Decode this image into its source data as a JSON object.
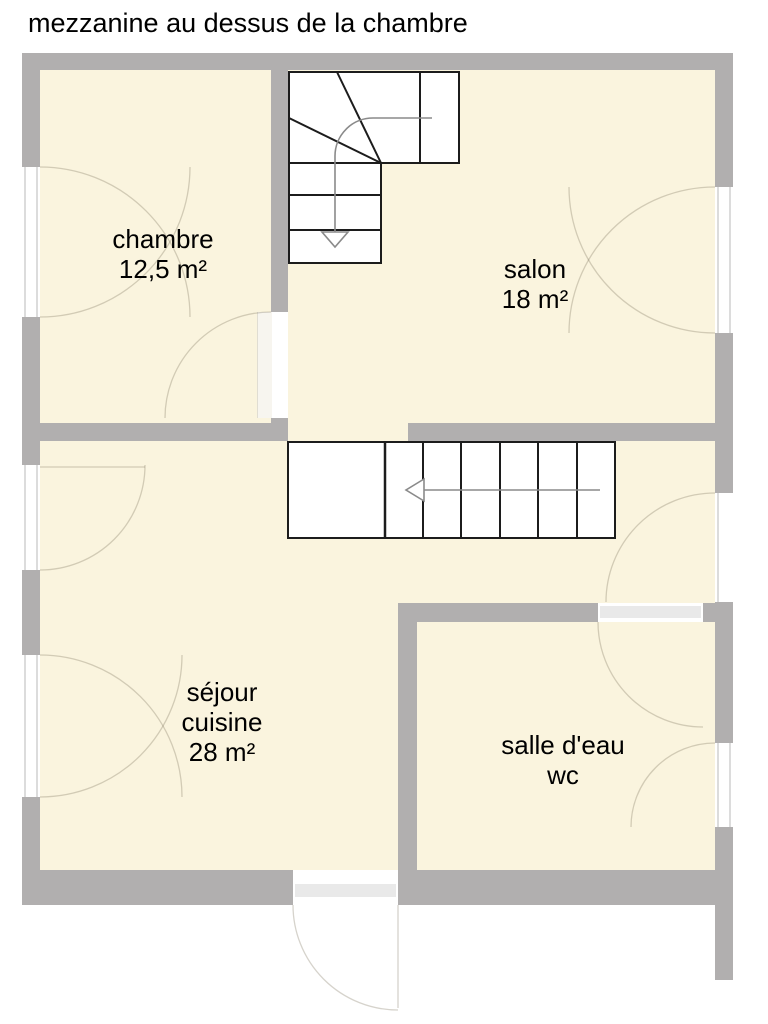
{
  "title": "mezzanine au dessus de la chambre",
  "rooms": {
    "chambre": {
      "name": "chambre",
      "area": "12,5 m²"
    },
    "salon": {
      "name": "salon",
      "area": "18 m²"
    },
    "sejour": {
      "name": "séjour",
      "name2": "cuisine",
      "area": "28 m²"
    },
    "salle_eau": {
      "name": "salle d'eau",
      "name2": "wc"
    }
  },
  "palette": {
    "wall_gray": "#b1afaf",
    "floor_cream": "#faf4de",
    "stair_line": "#1c1c1c",
    "guide_gray": "#8a8a8a",
    "opening_white": "#ffffff"
  }
}
